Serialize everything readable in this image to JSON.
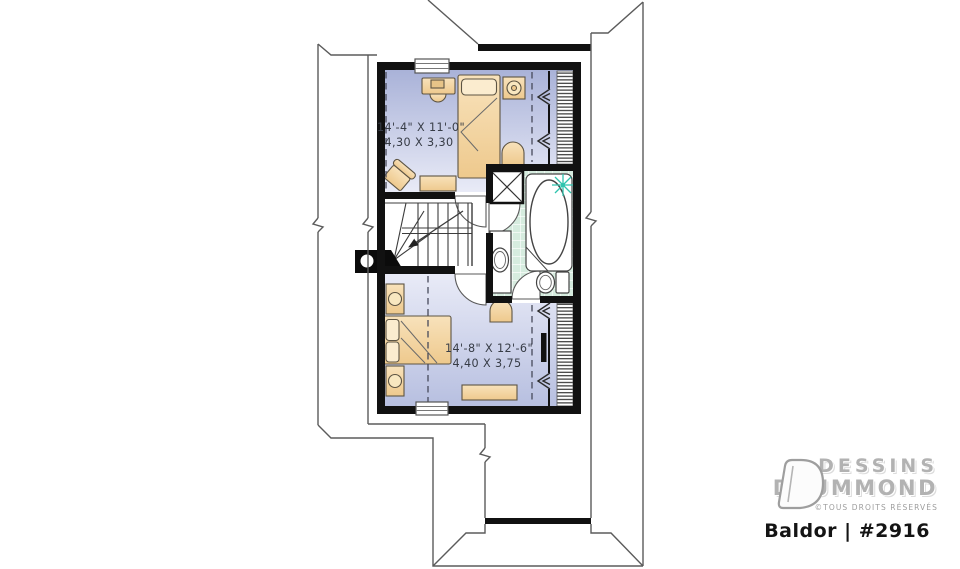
{
  "document": {
    "type": "architectural-floor-plan",
    "background": "#ffffff"
  },
  "rooms": [
    {
      "id": "bedroom-upper",
      "dim_imperial": "14'-4\" X 11'-0\"",
      "dim_metric": "4,30 X 3,30"
    },
    {
      "id": "bedroom-lower",
      "dim_imperial": "14'-8\" X 12'-6\"",
      "dim_metric": "4,40 X 3,75"
    }
  ],
  "branding": {
    "name_line1": "DESSINS",
    "name_line2": "DRUMMOND",
    "rights": "©TOUS DROITS RÉSERVÉS",
    "plan_label": "Baldor | #2916"
  },
  "colors": {
    "wall_black": "#111111",
    "floor_upper_dark": "#a9b2d8",
    "floor_light": "#e9ebf7",
    "floor_lower_dark": "#b7bfe0",
    "bath_tile_green": "#d6ecdf",
    "furniture_tan": "#f4d9a9",
    "plant_teal": "#2fc4ae",
    "logo_gray": "#b2b2b2",
    "label_text": "#373c46"
  }
}
